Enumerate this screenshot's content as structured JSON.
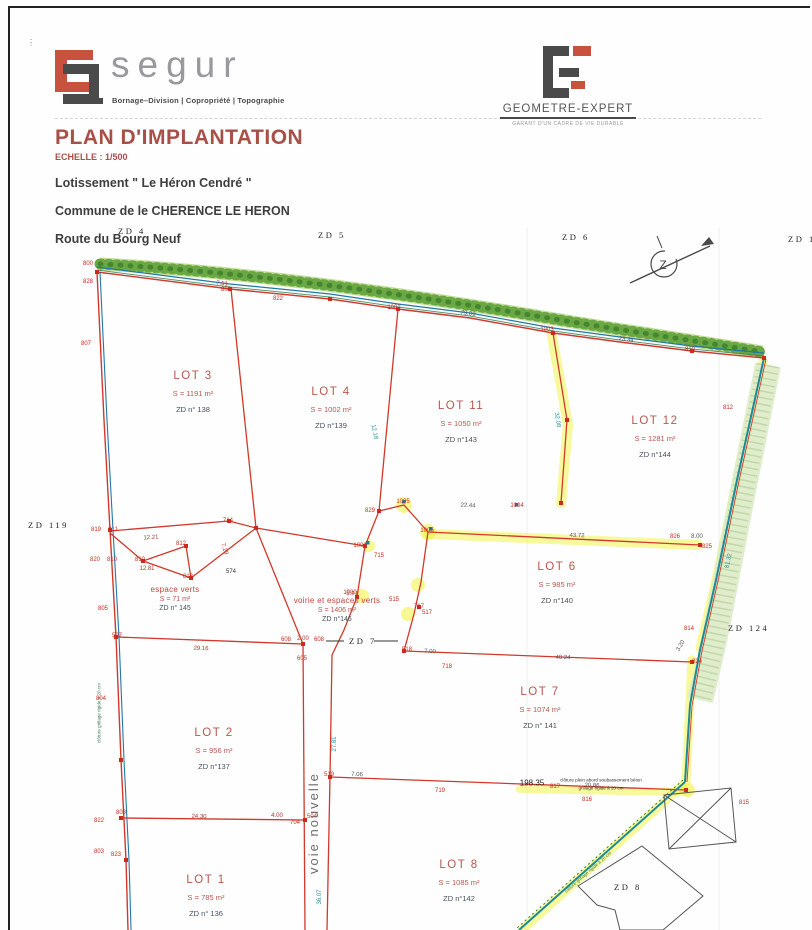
{
  "header": {
    "segur": {
      "name": "segur",
      "tagline": "Bornage–Division | Copropriété | Topographie"
    },
    "geometre": {
      "name": "GEOMETRE-EXPERT",
      "tagline": "GARANT D'UN CADRE DE VIE DURABLE"
    }
  },
  "title_block": {
    "title": "PLAN D'IMPLANTATION",
    "scale": "ECHELLE : 1/500",
    "line1": "Lotissement \" Le Héron Cendré \"",
    "line2": "Commune de le CHERENCE LE HERON",
    "line3": "Route du Bourg Neuf"
  },
  "plan": {
    "road_label": {
      "text": "voie  nouvelle"
    },
    "zones": [
      {
        "label": "ZD 4",
        "x": 118,
        "y": 226
      },
      {
        "label": "ZD 5",
        "x": 318,
        "y": 230
      },
      {
        "label": "ZD 6",
        "x": 562,
        "y": 232
      },
      {
        "label": "ZD 11",
        "x": 788,
        "y": 234
      },
      {
        "label": "ZD 119",
        "x": 28,
        "y": 520
      },
      {
        "label": "ZD 124",
        "x": 728,
        "y": 623
      },
      {
        "label": "ZD 7",
        "x": 349,
        "y": 636
      },
      {
        "label": "ZD 8",
        "x": 614,
        "y": 882
      }
    ],
    "lots": [
      {
        "name": "LOT 3",
        "area": "S = 1191 m²",
        "parcel": "ZD n° 138",
        "x": 193,
        "y": 370
      },
      {
        "name": "LOT 4",
        "area": "S = 1002 m²",
        "parcel": "ZD n°139",
        "x": 331,
        "y": 386
      },
      {
        "name": "LOT 11",
        "area": "S = 1050 m²",
        "parcel": "ZD n°143",
        "x": 461,
        "y": 400
      },
      {
        "name": "LOT 12",
        "area": "S = 1281 m²",
        "parcel": "ZD n°144",
        "x": 655,
        "y": 415
      },
      {
        "name": "LOT 6",
        "area": "S = 985 m²",
        "parcel": "ZD n°140",
        "x": 557,
        "y": 561
      },
      {
        "name": "LOT 7",
        "area": "S = 1074 m²",
        "parcel": "ZD n° 141",
        "x": 540,
        "y": 686
      },
      {
        "name": "LOT 2",
        "area": "S = 956 m²",
        "parcel": "ZD n°137",
        "x": 214,
        "y": 727
      },
      {
        "name": "LOT 1",
        "area": "S = 785 m²",
        "parcel": "ZD n° 136",
        "x": 206,
        "y": 874
      },
      {
        "name": "LOT 8",
        "area": "S = 1085 m²",
        "parcel": "ZD n°142",
        "x": 459,
        "y": 859
      }
    ],
    "green_areas": [
      {
        "name": "espace verts",
        "area": "S = 71 m²",
        "parcel": "ZD n° 145",
        "x": 175,
        "y": 585
      },
      {
        "name": "voirie et espaces verts",
        "area": "S = 1406 m²",
        "parcel": "ZD n°146",
        "x": 337,
        "y": 596
      }
    ],
    "points": [
      {
        "n": "800",
        "x": 88,
        "y": 264
      },
      {
        "n": "828",
        "x": 88,
        "y": 282
      },
      {
        "n": "807",
        "x": 86,
        "y": 344
      },
      {
        "n": "806",
        "x": 226,
        "y": 290
      },
      {
        "n": "822",
        "x": 278,
        "y": 299
      },
      {
        "n": "1002",
        "x": 394,
        "y": 308
      },
      {
        "n": "1003",
        "x": 547,
        "y": 330
      },
      {
        "n": "810",
        "x": 690,
        "y": 350
      },
      {
        "n": "812",
        "x": 728,
        "y": 408
      },
      {
        "n": "819",
        "x": 96,
        "y": 530
      },
      {
        "n": "811",
        "x": 113,
        "y": 530
      },
      {
        "n": "820",
        "x": 95,
        "y": 560
      },
      {
        "n": "810",
        "x": 112,
        "y": 560
      },
      {
        "n": "805",
        "x": 103,
        "y": 609
      },
      {
        "n": "507",
        "x": 117,
        "y": 636
      },
      {
        "n": "804",
        "x": 101,
        "y": 699
      },
      {
        "n": "808",
        "x": 121,
        "y": 813
      },
      {
        "n": "822",
        "x": 99,
        "y": 821
      },
      {
        "n": "803",
        "x": 99,
        "y": 852
      },
      {
        "n": "823",
        "x": 116,
        "y": 855
      },
      {
        "n": "812",
        "x": 181,
        "y": 544
      },
      {
        "n": "810",
        "x": 140,
        "y": 560
      },
      {
        "n": "813",
        "x": 188,
        "y": 577
      },
      {
        "n": "714",
        "x": 228,
        "y": 521
      },
      {
        "n": "829",
        "x": 370,
        "y": 511
      },
      {
        "n": "1005",
        "x": 403,
        "y": 502
      },
      {
        "n": "1006",
        "x": 427,
        "y": 531
      },
      {
        "n": "1004",
        "x": 517,
        "y": 506
      },
      {
        "n": "1001",
        "x": 360,
        "y": 546
      },
      {
        "n": "715",
        "x": 379,
        "y": 556
      },
      {
        "n": "717",
        "x": 419,
        "y": 607
      },
      {
        "n": "1000",
        "x": 350,
        "y": 593
      },
      {
        "n": "515",
        "x": 394,
        "y": 600
      },
      {
        "n": "517",
        "x": 427,
        "y": 613
      },
      {
        "n": "518",
        "x": 407,
        "y": 650
      },
      {
        "n": "718",
        "x": 447,
        "y": 667
      },
      {
        "n": "608",
        "x": 286,
        "y": 640
      },
      {
        "n": "608",
        "x": 319,
        "y": 640
      },
      {
        "n": "605",
        "x": 302,
        "y": 659
      },
      {
        "n": "519",
        "x": 329,
        "y": 775
      },
      {
        "n": "719",
        "x": 440,
        "y": 791
      },
      {
        "n": "817",
        "x": 555,
        "y": 787
      },
      {
        "n": "816",
        "x": 587,
        "y": 800
      },
      {
        "n": "815",
        "x": 744,
        "y": 803
      },
      {
        "n": "704",
        "x": 295,
        "y": 823
      },
      {
        "n": "504",
        "x": 312,
        "y": 817
      },
      {
        "n": "826",
        "x": 675,
        "y": 537
      },
      {
        "n": "825",
        "x": 707,
        "y": 547
      },
      {
        "n": "814",
        "x": 689,
        "y": 629
      },
      {
        "n": "824",
        "x": 697,
        "y": 662
      }
    ],
    "dims": [
      {
        "t": "7.51",
        "x": 222,
        "y": 284,
        "r": 6
      },
      {
        "t": "79.09",
        "x": 468,
        "y": 314,
        "r": 8,
        "c": "#555"
      },
      {
        "t": "23.34",
        "x": 626,
        "y": 340,
        "r": 8,
        "c": "#555"
      },
      {
        "t": "12.21",
        "x": 151,
        "y": 538,
        "r": -4
      },
      {
        "t": "12.81",
        "x": 147,
        "y": 569
      },
      {
        "t": "7.29",
        "x": 224,
        "y": 549,
        "r": 72
      },
      {
        "t": "574",
        "x": 231,
        "y": 572,
        "c": "#333"
      },
      {
        "t": "12.18",
        "x": 374,
        "y": 432,
        "r": 78,
        "c": "#2a8f9c"
      },
      {
        "t": "32.08",
        "x": 557,
        "y": 420,
        "r": 81,
        "c": "#2a8f9c"
      },
      {
        "t": "22.44",
        "x": 468,
        "y": 506,
        "r": 3,
        "c": "#555"
      },
      {
        "t": "43.72",
        "x": 577,
        "y": 536,
        "r": 2,
        "c": "#555"
      },
      {
        "t": "5.91",
        "x": 352,
        "y": 594,
        "r": 3
      },
      {
        "t": "2.00",
        "x": 303,
        "y": 639
      },
      {
        "t": "29.16",
        "x": 201,
        "y": 649,
        "r": 2
      },
      {
        "t": "27.81",
        "x": 335,
        "y": 744,
        "r": -90,
        "c": "#2a8f9c"
      },
      {
        "t": "7.00",
        "x": 430,
        "y": 652,
        "r": 2,
        "c": "#555"
      },
      {
        "t": "40.24",
        "x": 563,
        "y": 658,
        "r": 2,
        "c": "#555"
      },
      {
        "t": "3.20",
        "x": 681,
        "y": 646,
        "r": -60,
        "c": "#555"
      },
      {
        "t": "7.06",
        "x": 357,
        "y": 775,
        "r": 2,
        "c": "#555"
      },
      {
        "t": "20.86",
        "x": 592,
        "y": 786,
        "r": 2,
        "c": "#555"
      },
      {
        "t": "24.30",
        "x": 199,
        "y": 817,
        "r": 1
      },
      {
        "t": "4.00",
        "x": 277,
        "y": 816
      },
      {
        "t": "8.00",
        "x": 697,
        "y": 537,
        "c": "#555"
      },
      {
        "t": "81.32",
        "x": 729,
        "y": 561,
        "r": -78,
        "c": "#2a8f9c"
      },
      {
        "t": "36.07",
        "x": 320,
        "y": 897,
        "r": -90,
        "c": "#2a8f9c"
      },
      {
        "t": "198.35",
        "x": 532,
        "y": 783,
        "fs": 8,
        "c": "#222"
      }
    ],
    "notes": [
      {
        "t": "clôture plein abord soubassement béton",
        "x": 601,
        "y": 780
      },
      {
        "t": "grillage rigide à 20 cm",
        "x": 601,
        "y": 788
      },
      {
        "t": "clôture grillage rigide à 20 cm",
        "x": 99,
        "y": 713,
        "r": -90,
        "c": "#3c7a52"
      },
      {
        "t": "clôture grillage rigide à 20 cm",
        "x": 588,
        "y": 872,
        "r": -41,
        "c": "#3c7a52"
      },
      {
        "t": "Z",
        "x": 663,
        "y": 265,
        "fs": 12,
        "c": "#444"
      }
    ],
    "colors": {
      "boundary_red": "#d0392b",
      "existing_blue": "#2277aa",
      "fence_teal": "#1b8a9a",
      "hedge_green": "#6aa844",
      "highlight_yellow": "#f2f23a",
      "accent": "#c9523f",
      "title": "#a85048"
    }
  }
}
